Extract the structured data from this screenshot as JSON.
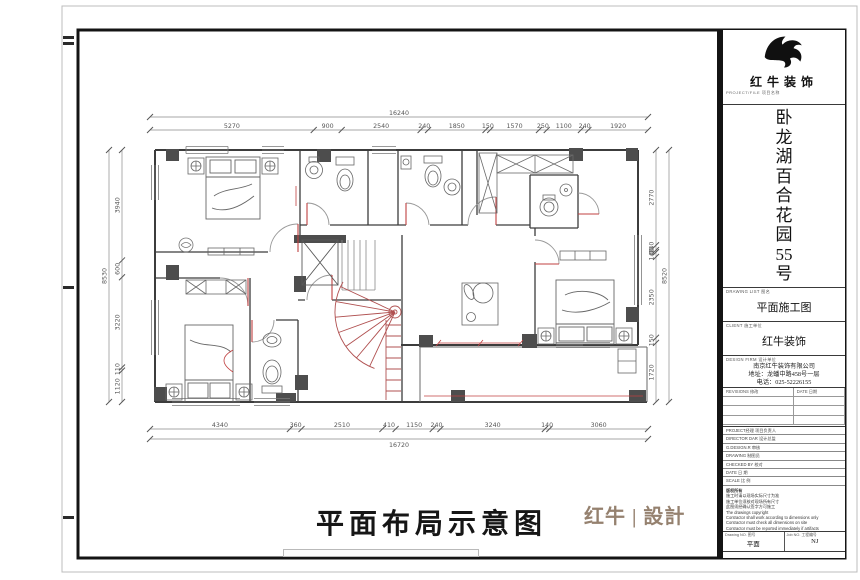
{
  "title_block": {
    "brand": "红牛装饰",
    "brand_caption": "PROJECT/FILE 项目名称",
    "project_name": "卧龙湖百合花园55号",
    "drawing_list_label": "DRAWING LIST 图名",
    "drawing_title": "平面施工图",
    "client_label": "CLIENT 施工单位",
    "client_value": "红牛装饰",
    "design_firm_label": "DESIGN FIRM 设计单位",
    "company_lines": [
      "南京红牛装饰有限公司",
      "地址：龙蟠中路458号一层",
      "电话：025-52226155"
    ],
    "revisions_label": "REVISIONS 修改",
    "date_label": "DATE 日期",
    "info_rows": [
      "PROJECT经理 项目负责人",
      "DIRECTOR DAR 设计总监",
      "G.DESIGN.R 审核",
      "DRAWING 制图员",
      "CHECKED BY 校对",
      "DATE 日 期",
      "SCALE 比 例"
    ],
    "notes_title": "版权所有",
    "notes_lines": [
      "施工时请以现场实际尺寸为准",
      "施工单位须核对现场所有尺寸",
      "此图须经确认签字方可施工",
      "The drawings copyright",
      "Contractor shall work according to dimensions only",
      "Contractor must check all dimensions on site",
      "Contractor must be reported immediately if artifacts"
    ],
    "drawing_no_label": "Drawing NO. 图号",
    "drawing_no_value": "平面",
    "job_no_label": "Job NO. 工程编号",
    "job_no_value": "NJ"
  },
  "footer": {
    "main_title": "平面布局示意图",
    "brand_logo": "红牛 | 設計"
  },
  "plan": {
    "dimensions": {
      "top": {
        "segments": [
          "5270",
          "900",
          "2540",
          "240",
          "1850",
          "150",
          "1570",
          "250",
          "1100",
          "240",
          "1920"
        ],
        "overall": "16240"
      },
      "bottom": {
        "segments": [
          "4340",
          "360",
          "2510",
          "410",
          "1150",
          "240",
          "3240",
          "140",
          "3060"
        ],
        "overall": "16720"
      },
      "left": {
        "segments": [
          "3940",
          "600",
          "3220",
          "110",
          "1120"
        ],
        "overall": "8530"
      },
      "right": {
        "segments": [
          "2770",
          "140",
          "60",
          "140",
          "2350",
          "150",
          "1720"
        ],
        "overall": "8520"
      }
    },
    "colors": {
      "wall": "#3c3c3c",
      "dim": "#8a8a8a",
      "red": "#c04040",
      "column": "#4d4d4d"
    }
  }
}
